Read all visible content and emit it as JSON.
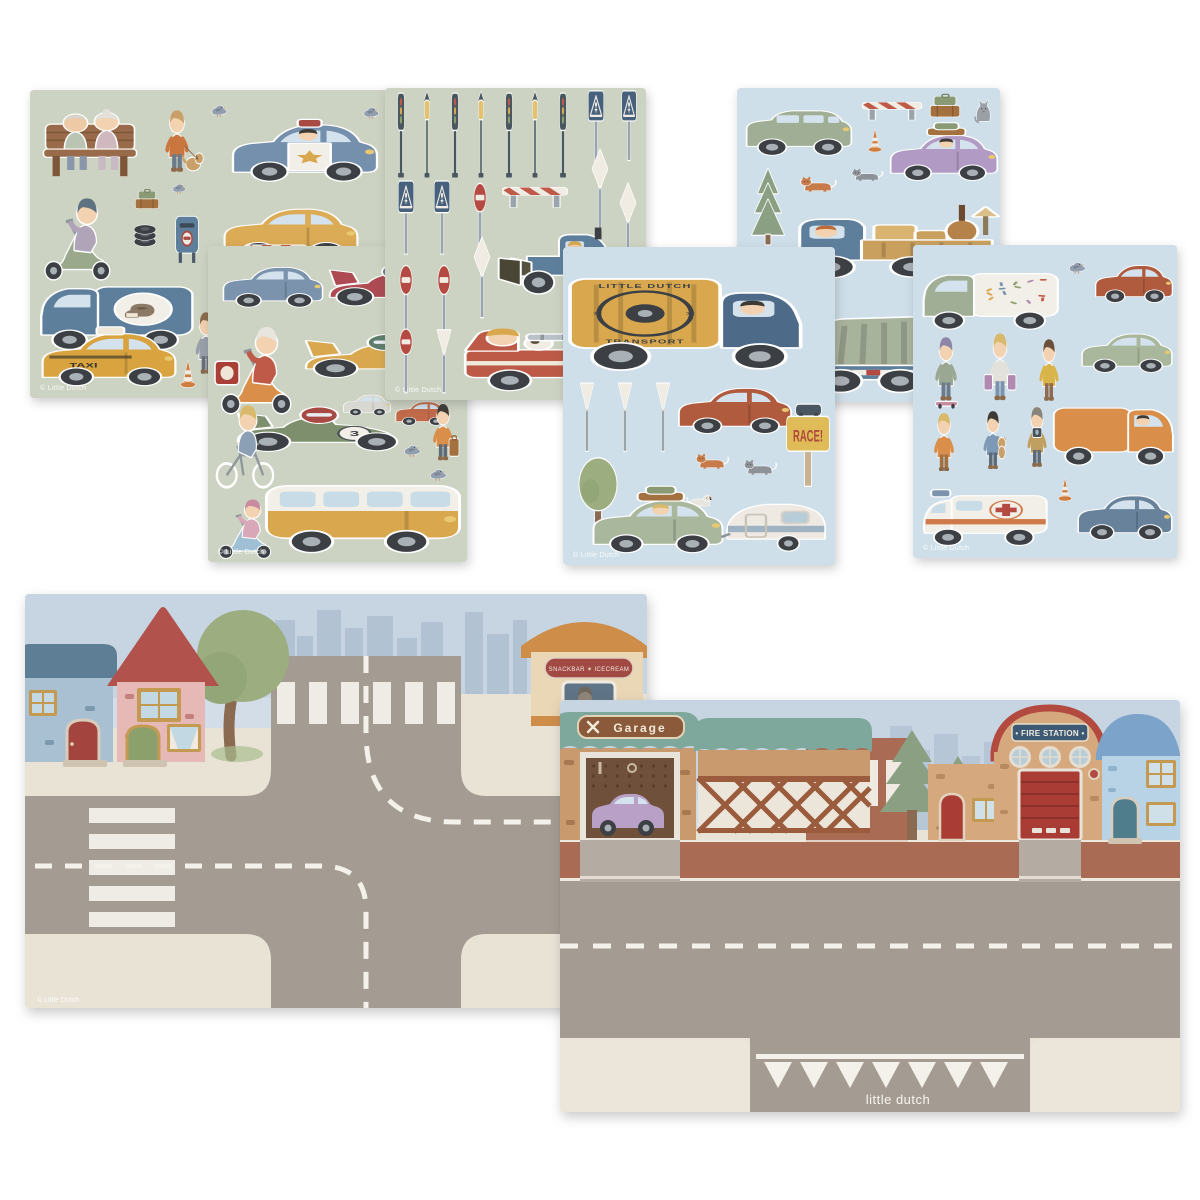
{
  "texts": {
    "taxi": "TAXI",
    "race12": "12",
    "race3": "3",
    "race_sign": "RACE!",
    "transport_top": "LITTLE DUTCH",
    "transport_bottom": "TRANSPORT",
    "garage": "Garage",
    "fire": "• FIRE STATION •",
    "snack": "SNACKBAR ✶ ICECREAM",
    "brand": "little dutch",
    "copyright": "© Little Dutch"
  },
  "palette": {
    "canvas": "#ffffff",
    "sheet_green": "#cdd3c2",
    "sheet_blue": "#cfdfe9",
    "sky": "#c7d5e2",
    "skyline": "#aebfd0",
    "sidewalk": "#e9e3d6",
    "road": "#a49b92",
    "brick_road": "#a96b54",
    "marking_white": "#f3f1ea",
    "roof_teal": "#7fa89d",
    "garage_wall": "#c89a6e",
    "fire_red": "#b24a40",
    "sign_blue": "#3d5974",
    "blue_house": "#a9c0d3",
    "pink_house": "#e7b9b6"
  },
  "sheets": [
    {
      "name": "sticker-sheet-town-vehicles",
      "bg": "#cdd3c2",
      "x": 30,
      "y": 90,
      "w": 365,
      "h": 308,
      "z": 1,
      "stickers": [
        {
          "type": "bench",
          "x": 8,
          "y": 16,
          "w": 104,
          "h": 78
        },
        {
          "type": "person",
          "x": 120,
          "y": 18,
          "w": 54,
          "h": 70,
          "hair": "#caa06a",
          "shirt": "#c9763f",
          "pants": "#6b7b8c",
          "item": "dog"
        },
        {
          "type": "pigeon",
          "x": 174,
          "y": 6,
          "w": 30,
          "h": 26
        },
        {
          "type": "car",
          "x": 198,
          "y": 16,
          "w": 154,
          "h": 82,
          "color": "#7590ad",
          "police": true,
          "driver": "#3e3a36"
        },
        {
          "type": "pigeon",
          "x": 326,
          "y": 8,
          "w": 30,
          "h": 26
        },
        {
          "type": "scooter",
          "x": 6,
          "y": 98,
          "w": 88,
          "h": 94,
          "color": "#9aa98c",
          "helmet": "#5f7280",
          "shirt": "#b0a4b8"
        },
        {
          "type": "suitcases",
          "x": 98,
          "y": 96,
          "w": 38,
          "h": 30
        },
        {
          "type": "pigeon",
          "x": 136,
          "y": 86,
          "w": 26,
          "h": 22
        },
        {
          "type": "tires",
          "x": 96,
          "y": 128,
          "w": 38,
          "h": 34
        },
        {
          "type": "mailbox",
          "x": 134,
          "y": 114,
          "w": 46,
          "h": 64
        },
        {
          "type": "car",
          "x": 190,
          "y": 102,
          "w": 142,
          "h": 74,
          "color": "#dcab55"
        },
        {
          "type": "van",
          "x": 6,
          "y": 176,
          "w": 160,
          "h": 90,
          "color": "#5e7f9c",
          "cargo": "#5e7f9c",
          "birdlogo": true,
          "flip": true
        },
        {
          "type": "person",
          "x": 170,
          "y": 158,
          "w": 46,
          "h": 66,
          "hair": "#3e3a36",
          "shirt": "#8a97a8",
          "pants": "#5d6a77",
          "item": "cat"
        },
        {
          "type": "barrier",
          "x": 212,
          "y": 146,
          "w": 68,
          "h": 32
        },
        {
          "type": "car",
          "x": 8,
          "y": 226,
          "w": 142,
          "h": 76,
          "color": "#d9a440",
          "taxi": true,
          "label_ref": "taxi"
        },
        {
          "type": "person",
          "x": 152,
          "y": 220,
          "w": 48,
          "h": 70,
          "hair": "#8a6a4a",
          "shirt": "#9aa0aa",
          "pants": "#69707d",
          "item": "dog"
        },
        {
          "type": "cone",
          "x": 144,
          "y": 266,
          "w": 28,
          "h": 34
        },
        {
          "type": "cone",
          "x": 176,
          "y": 260,
          "w": 26,
          "h": 32
        },
        {
          "type": "cone",
          "x": 198,
          "y": 272,
          "w": 26,
          "h": 30
        }
      ]
    },
    {
      "name": "sticker-sheet-race-cars",
      "bg": "#cdd3c2",
      "x": 208,
      "y": 246,
      "w": 259,
      "h": 316,
      "z": 2,
      "stickers": [
        {
          "type": "car",
          "x": 12,
          "y": 8,
          "w": 106,
          "h": 58,
          "color": "#7b93ad"
        },
        {
          "type": "racecar",
          "x": 120,
          "y": 2,
          "w": 134,
          "h": 66,
          "color": "#ad4a52",
          "helmet": "#6f7f92"
        },
        {
          "type": "scooter",
          "x": 4,
          "y": 70,
          "w": 94,
          "h": 100,
          "color": "#d98e4a",
          "helmet": "#e8e4de",
          "shirt": "#c05a48",
          "box": true
        },
        {
          "type": "racecar",
          "x": 96,
          "y": 72,
          "w": 158,
          "h": 68,
          "color": "#d9a84e",
          "helmet": "#5f7d6a",
          "num_ref": "race12"
        },
        {
          "type": "car",
          "x": 134,
          "y": 142,
          "w": 50,
          "h": 30,
          "color": "#d8d8d2"
        },
        {
          "type": "car",
          "x": 186,
          "y": 148,
          "w": 56,
          "h": 34,
          "color": "#c06a4a"
        },
        {
          "type": "racecar",
          "x": 28,
          "y": 144,
          "w": 160,
          "h": 70,
          "color": "#7e8f6e",
          "helmet": "#a84a44",
          "num_ref": "race3"
        },
        {
          "type": "bike",
          "x": 2,
          "y": 152,
          "w": 76,
          "h": 92,
          "hair": "#d9b96a",
          "shirt": "#8ca0b5"
        },
        {
          "type": "person",
          "x": 212,
          "y": 156,
          "w": 46,
          "h": 64,
          "hair": "#3e3a36",
          "shirt": "#d98e4a",
          "pants": "#5d6a77",
          "item": "case"
        },
        {
          "type": "pigeon",
          "x": 188,
          "y": 190,
          "w": 32,
          "h": 26
        },
        {
          "type": "pigeon",
          "x": 214,
          "y": 214,
          "w": 32,
          "h": 26
        },
        {
          "type": "scooter",
          "x": 4,
          "y": 246,
          "w": 70,
          "h": 68,
          "color": "#9fc0d4",
          "helmet": "#c98ba0",
          "shirt": "#d8a8b8"
        },
        {
          "type": "bus",
          "x": 56,
          "y": 212,
          "w": 198,
          "h": 102,
          "color": "#d9a84e"
        }
      ]
    },
    {
      "name": "sticker-sheet-traffic-signs",
      "bg": "#cdd3c2",
      "x": 385,
      "y": 88,
      "w": 261,
      "h": 312,
      "z": 3,
      "stickers": [
        {
          "type": "trafficlight",
          "x": 4,
          "y": 4,
          "w": 24,
          "h": 90
        },
        {
          "type": "lamp",
          "x": 32,
          "y": 4,
          "w": 20,
          "h": 90
        },
        {
          "type": "trafficlight",
          "x": 58,
          "y": 4,
          "w": 24,
          "h": 90
        },
        {
          "type": "lamp",
          "x": 86,
          "y": 4,
          "w": 20,
          "h": 90
        },
        {
          "type": "trafficlight",
          "x": 112,
          "y": 4,
          "w": 24,
          "h": 90
        },
        {
          "type": "lamp",
          "x": 140,
          "y": 4,
          "w": 20,
          "h": 90
        },
        {
          "type": "trafficlight",
          "x": 166,
          "y": 4,
          "w": 24,
          "h": 90
        },
        {
          "type": "crosssign",
          "x": 194,
          "y": 2,
          "w": 34,
          "h": 76
        },
        {
          "type": "crosssign",
          "x": 228,
          "y": 2,
          "w": 32,
          "h": 76
        },
        {
          "type": "diamond",
          "x": 198,
          "y": 62,
          "w": 34,
          "h": 86
        },
        {
          "type": "diamond",
          "x": 226,
          "y": 96,
          "w": 34,
          "h": 86
        },
        {
          "type": "crosssign",
          "x": 4,
          "y": 92,
          "w": 34,
          "h": 80
        },
        {
          "type": "crosssign",
          "x": 40,
          "y": 92,
          "w": 34,
          "h": 80
        },
        {
          "type": "noentry",
          "x": 78,
          "y": 92,
          "w": 34,
          "h": 80
        },
        {
          "type": "barrier",
          "x": 114,
          "y": 90,
          "w": 72,
          "h": 34
        },
        {
          "type": "tractor",
          "x": 116,
          "y": 118,
          "w": 134,
          "h": 98
        },
        {
          "type": "noentry",
          "x": 4,
          "y": 174,
          "w": 34,
          "h": 82
        },
        {
          "type": "noentry",
          "x": 42,
          "y": 174,
          "w": 34,
          "h": 82
        },
        {
          "type": "diamond",
          "x": 80,
          "y": 150,
          "w": 34,
          "h": 86
        },
        {
          "type": "noentry",
          "x": 4,
          "y": 238,
          "w": 34,
          "h": 72
        },
        {
          "type": "yield",
          "x": 42,
          "y": 238,
          "w": 34,
          "h": 72
        },
        {
          "type": "firetruck",
          "x": 78,
          "y": 222,
          "w": 180,
          "h": 88
        }
      ]
    },
    {
      "name": "sticker-sheet-transport-camping",
      "bg": "#cfdfe9",
      "x": 563,
      "y": 247,
      "w": 272,
      "h": 318,
      "z": 6,
      "stickers": [
        {
          "type": "truckbox",
          "x": 4,
          "y": 12,
          "w": 244,
          "h": 116,
          "color": "#d9a84e",
          "cab": "#4d6b88",
          "logo": true,
          "top_ref": "transport_top",
          "bottom_ref": "transport_bottom"
        },
        {
          "type": "yield",
          "x": 8,
          "y": 132,
          "w": 32,
          "h": 78
        },
        {
          "type": "yield",
          "x": 46,
          "y": 132,
          "w": 32,
          "h": 78
        },
        {
          "type": "yield",
          "x": 84,
          "y": 132,
          "w": 32,
          "h": 78
        },
        {
          "type": "car",
          "x": 112,
          "y": 126,
          "w": 120,
          "h": 66,
          "color": "#b05a3e"
        },
        {
          "type": "tree",
          "x": 4,
          "y": 208,
          "w": 62,
          "h": 86
        },
        {
          "type": "cat",
          "x": 128,
          "y": 196,
          "w": 42,
          "h": 32,
          "color": "#c77b4a"
        },
        {
          "type": "cat",
          "x": 176,
          "y": 202,
          "w": 42,
          "h": 32,
          "color": "#8d9298"
        },
        {
          "type": "dog",
          "x": 118,
          "y": 236,
          "w": 38,
          "h": 30,
          "color": "#e8e4de"
        },
        {
          "type": "racesign",
          "x": 220,
          "y": 156,
          "w": 50,
          "h": 88,
          "label_ref": "race_sign"
        },
        {
          "type": "car",
          "x": 26,
          "y": 236,
          "w": 138,
          "h": 76,
          "color": "#a9b79c",
          "luggage": true,
          "driver": "#d9b96a"
        },
        {
          "type": "caravan",
          "x": 156,
          "y": 234,
          "w": 112,
          "h": 80
        }
      ]
    },
    {
      "name": "sticker-sheet-trucks",
      "bg": "#cfdfe9",
      "x": 737,
      "y": 88,
      "w": 263,
      "h": 314,
      "z": 4,
      "stickers": [
        {
          "type": "suv",
          "x": 6,
          "y": 8,
          "w": 112,
          "h": 64,
          "color": "#9fae94"
        },
        {
          "type": "barrier",
          "x": 122,
          "y": 6,
          "w": 66,
          "h": 30
        },
        {
          "type": "cone",
          "x": 126,
          "y": 38,
          "w": 24,
          "h": 28
        },
        {
          "type": "suitcases",
          "x": 184,
          "y": 2,
          "w": 48,
          "h": 36
        },
        {
          "type": "car",
          "x": 150,
          "y": 32,
          "w": 114,
          "h": 66,
          "color": "#b19ac4",
          "driver": "#3e3a36",
          "luggage": true
        },
        {
          "type": "catsit",
          "x": 230,
          "y": 2,
          "w": 32,
          "h": 36,
          "color": "#9aa0a6"
        },
        {
          "type": "pine",
          "x": 6,
          "y": 78,
          "w": 50,
          "h": 80
        },
        {
          "type": "cat",
          "x": 58,
          "y": 78,
          "w": 46,
          "h": 32,
          "color": "#c77b4a"
        },
        {
          "type": "cat",
          "x": 110,
          "y": 72,
          "w": 40,
          "h": 26,
          "color": "#8d9298"
        },
        {
          "type": "opentruck",
          "x": 56,
          "y": 100,
          "w": 206,
          "h": 94
        },
        {
          "type": "kickscooter",
          "x": 2,
          "y": 162,
          "w": 68,
          "h": 82,
          "hair": "#2f2b28",
          "shirt": "#c9763f",
          "pants": "#5d6a77"
        },
        {
          "type": "person",
          "x": 6,
          "y": 244,
          "w": 54,
          "h": 66,
          "hair": "#2f2b28",
          "shirt": "#8a92a0",
          "pants": "#69707d",
          "item": "guitar"
        },
        {
          "type": "garbage",
          "x": 64,
          "y": 204,
          "w": 198,
          "h": 106,
          "color": "#a8b39c"
        }
      ]
    },
    {
      "name": "sticker-sheet-city-kids",
      "bg": "#cfdfe9",
      "x": 913,
      "y": 245,
      "w": 264,
      "h": 313,
      "z": 5,
      "stickers": [
        {
          "type": "van",
          "x": 6,
          "y": 10,
          "w": 142,
          "h": 80,
          "color": "#9fae94",
          "cargo": "#f2efe8",
          "sprinkles": true,
          "flip": true
        },
        {
          "type": "pigeon",
          "x": 148,
          "y": 8,
          "w": 32,
          "h": 26
        },
        {
          "type": "car",
          "x": 180,
          "y": 8,
          "w": 82,
          "h": 54,
          "color": "#b05a3e"
        },
        {
          "type": "car",
          "x": 166,
          "y": 76,
          "w": 96,
          "h": 56,
          "color": "#a9b79c"
        },
        {
          "type": "person",
          "x": 8,
          "y": 90,
          "w": 50,
          "h": 72,
          "hair": "#8d86a8",
          "shirt": "#9aa893",
          "pants": "#6b7b8c",
          "item": "skateboard"
        },
        {
          "type": "person",
          "x": 62,
          "y": 86,
          "w": 50,
          "h": 76,
          "hair": "#d9b96a",
          "shirt": "#e3e1dc",
          "pants": "#7b93ad",
          "item": "bags"
        },
        {
          "type": "person",
          "x": 114,
          "y": 92,
          "w": 44,
          "h": 70,
          "hair": "#6b4f3a",
          "shirt": "#d9b44a",
          "pants": "#8d6a50"
        },
        {
          "type": "person",
          "x": 8,
          "y": 166,
          "w": 46,
          "h": 66,
          "hair": "#d9b96a",
          "shirt": "#d98e4a",
          "pants": "#a3703f"
        },
        {
          "type": "person",
          "x": 58,
          "y": 164,
          "w": 44,
          "h": 66,
          "hair": "#3e3a36",
          "shirt": "#7d99b5",
          "pants": "#5d6a77",
          "item": "teddy"
        },
        {
          "type": "person",
          "x": 102,
          "y": 160,
          "w": 44,
          "h": 68,
          "hair": "#8a8478",
          "shirt": "#c0a060",
          "pants": "#5d6a77",
          "item": "camera"
        },
        {
          "type": "van",
          "x": 138,
          "y": 144,
          "w": 126,
          "h": 82,
          "color": "#d98e4a",
          "cargo": "#d98e4a",
          "driver": "#3e3a36"
        },
        {
          "type": "cone",
          "x": 140,
          "y": 230,
          "w": 24,
          "h": 28
        },
        {
          "type": "ambulance",
          "x": 6,
          "y": 230,
          "w": 132,
          "h": 76
        },
        {
          "type": "car",
          "x": 162,
          "y": 236,
          "w": 100,
          "h": 64,
          "color": "#68829c"
        }
      ]
    }
  ]
}
